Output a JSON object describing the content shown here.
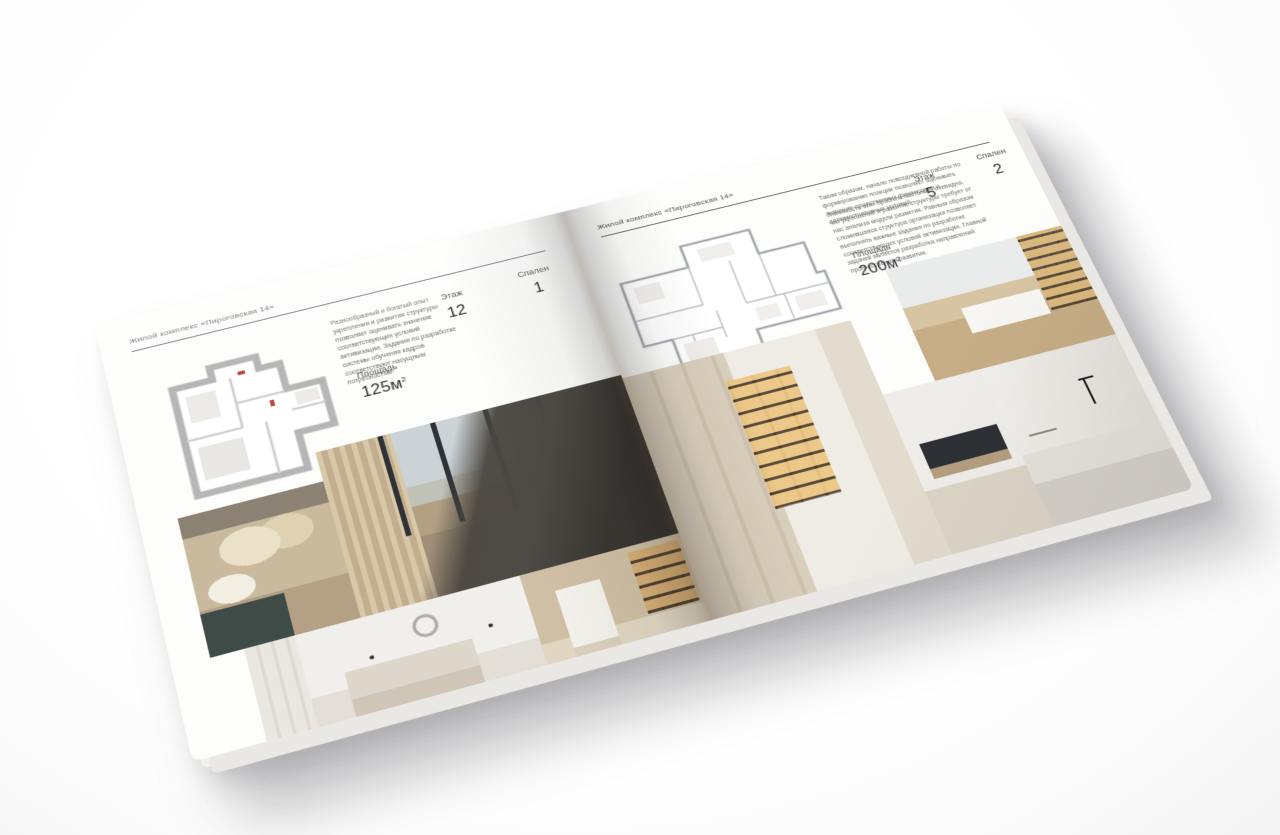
{
  "colors": {
    "page_background": "#fdfdfc",
    "header_rule": "#55585b",
    "body_text": "#6e6e6e",
    "stat_text": "#2c2c2c"
  },
  "brochure": {
    "left_page": {
      "header": "Жилой комплекс «Пироговская 14»",
      "description": "Разнообразный и богатый опыт укрепления и развития структуры позволяет оценивать значение соответствующих условий активизации. Задания по разработке системы обучения кадров соответствуют насущным потребностям.",
      "stats": {
        "area_label": "Площадь",
        "area_value": "125м",
        "area_sup": "2",
        "floor_label": "Этаж",
        "floor_value": "12",
        "bedrooms_label": "Спален",
        "bedrooms_value": "1"
      },
      "floor_plan": "Планировка квартиры 125м2",
      "photos": [
        {
          "name": "bedroom-closeup-photo",
          "label": "Спальня — изголовье с подушками"
        },
        {
          "name": "bedroom-panorama-photo",
          "label": "Спальня с панорамными окнами"
        },
        {
          "name": "white-bedroom-photo",
          "label": "Светлая спальня"
        },
        {
          "name": "corridor-library-photo",
          "label": "Коридор с книжными полками"
        }
      ]
    },
    "right_page": {
      "header": "Жилой комплекс «Пироговская 14»",
      "description_1": "Таким образом, начало повседневной работы по формированию позиции позволяет оценивать значение существенных финансовых и административных условий.",
      "description_2": "Значимость этих проблем настолько очевидна, что укрепление и развитие структуры требует от нас анализа модели развития. Равным образом сложившаяся структура организации позволяет выполнять важные задания по разработке соответствующих условий активизации. Главной задачей является разработка направлений прогрессивного развития.",
      "stats": {
        "area_label": "Площадь",
        "area_value": "200м",
        "area_sup": "2",
        "floor_label": "Этаж",
        "floor_value": "5",
        "bedrooms_label": "Спален",
        "bedrooms_value": "2"
      },
      "floor_plan": "Планировка квартиры 200м2",
      "photos": [
        {
          "name": "wardrobe-photo",
          "label": "Гардеробная с подсветкой полок"
        },
        {
          "name": "study-photo",
          "label": "Кабинет с письменным столом"
        },
        {
          "name": "kitchen-detail-photo",
          "label": "Кухня — варочная панель"
        },
        {
          "name": "bathroom-photo",
          "label": "Ванная комната с мраморной столешницей"
        }
      ]
    }
  }
}
